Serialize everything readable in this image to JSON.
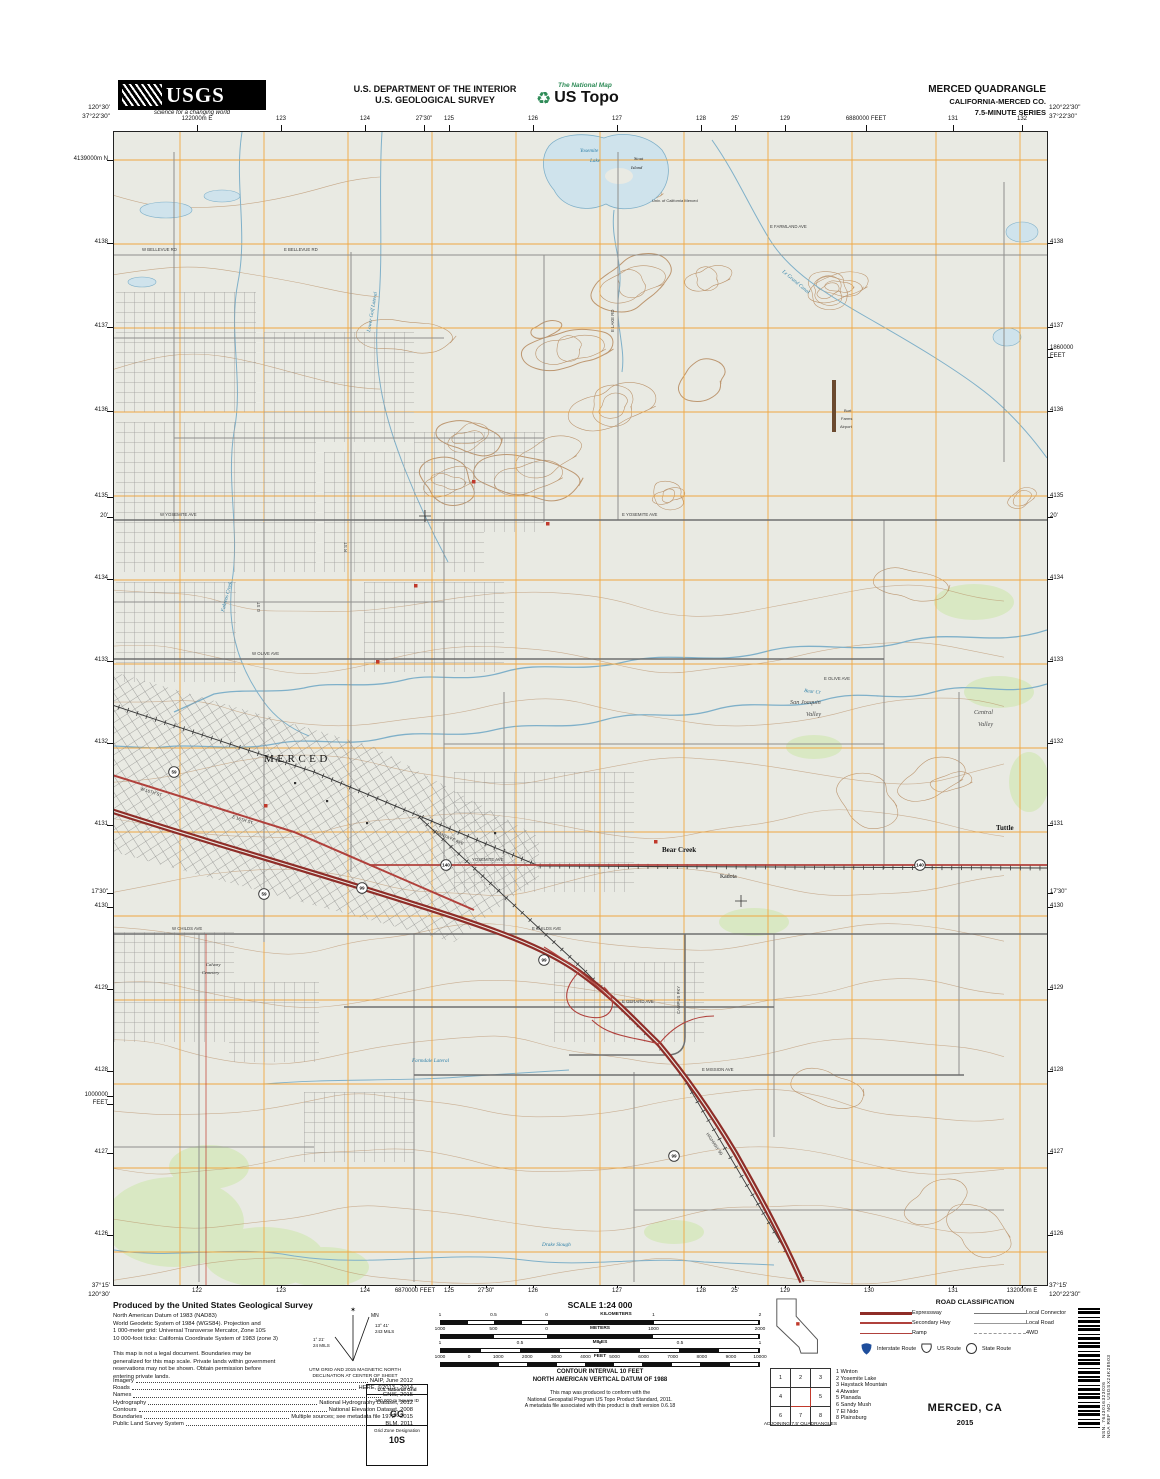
{
  "header": {
    "usgs": "USGS",
    "usgs_tag": "science for a changing world",
    "dept1": "U.S. DEPARTMENT OF THE INTERIOR",
    "dept2": "U.S. GEOLOGICAL SURVEY",
    "natmap": "The National Map",
    "ustopo": "US Topo",
    "quad": "MERCED QUADRANGLE",
    "state": "CALIFORNIA-MERCED CO.",
    "series": "7.5-MINUTE SERIES"
  },
  "collar": {
    "corners": {
      "tl1": "120°30'",
      "tl2": "37°22'30\"",
      "tr1": "120°22'30\"",
      "tr2": "37°22'30\"",
      "bl1": "37°15'",
      "bl2": "120°30'",
      "br1": "37°15'",
      "br2": "120°22'30\""
    },
    "top": [
      [
        "122000m E",
        197
      ],
      [
        "123",
        281
      ],
      [
        "124",
        365
      ],
      [
        "27'30\"",
        424
      ],
      [
        "125",
        449
      ],
      [
        "126",
        533
      ],
      [
        "127",
        617
      ],
      [
        "128",
        701
      ],
      [
        "25'",
        735
      ],
      [
        "129",
        785
      ],
      [
        "6880000 FEET",
        866
      ],
      [
        "131",
        953
      ],
      [
        "132",
        1022
      ]
    ],
    "bottom": [
      [
        "122",
        197
      ],
      [
        "123",
        281
      ],
      [
        "124",
        365
      ],
      [
        "6870000 FEET",
        415
      ],
      [
        "125",
        449
      ],
      [
        "27'30\"",
        486
      ],
      [
        "126",
        533
      ],
      [
        "127",
        617
      ],
      [
        "128",
        701
      ],
      [
        "25'",
        735
      ],
      [
        "129",
        785
      ],
      [
        "130",
        869
      ],
      [
        "131",
        953
      ],
      [
        "132000m E",
        1022
      ]
    ],
    "left": [
      [
        "4139000m N",
        160
      ],
      [
        "4138",
        243
      ],
      [
        "4137",
        327
      ],
      [
        "4136",
        411
      ],
      [
        "4135",
        497
      ],
      [
        "20'",
        517
      ],
      [
        "4134",
        579
      ],
      [
        "4133",
        661
      ],
      [
        "4132",
        743
      ],
      [
        "4131",
        825
      ],
      [
        "17'30\"",
        893
      ],
      [
        "4130",
        907
      ],
      [
        "4129",
        989
      ],
      [
        "4128",
        1071
      ],
      [
        "1000000",
        1096
      ],
      [
        "FEET",
        1104
      ],
      [
        "4127",
        1153
      ],
      [
        "4126",
        1235
      ]
    ],
    "right": [
      [
        "4138",
        243
      ],
      [
        "4137",
        327
      ],
      [
        "1860000",
        349
      ],
      [
        "FEET",
        357
      ],
      [
        "4136",
        411
      ],
      [
        "4135",
        497
      ],
      [
        "20'",
        517
      ],
      [
        "4134",
        579
      ],
      [
        "4133",
        661
      ],
      [
        "4132",
        743
      ],
      [
        "4131",
        825
      ],
      [
        "17'30\"",
        893
      ],
      [
        "4130",
        907
      ],
      [
        "4129",
        989
      ],
      [
        "4128",
        1071
      ],
      [
        "4127",
        1153
      ],
      [
        "4126",
        1235
      ]
    ]
  },
  "map": {
    "labels": [
      {
        "t": "MERCED",
        "x": 150,
        "y": 630,
        "c": "big"
      },
      {
        "t": "Bear Creek",
        "x": 548,
        "y": 720,
        "c": "place-b"
      },
      {
        "t": "Kadota",
        "x": 606,
        "y": 746,
        "c": "place"
      },
      {
        "t": "Tuttle",
        "x": 882,
        "y": 698,
        "c": "place-b"
      },
      {
        "t": "San Joaquin",
        "x": 676,
        "y": 572,
        "c": "valley"
      },
      {
        "t": "Valley",
        "x": 692,
        "y": 584,
        "c": "valley"
      },
      {
        "t": "Central",
        "x": 860,
        "y": 582,
        "c": "valley"
      },
      {
        "t": "Valley",
        "x": 864,
        "y": 594,
        "c": "valley"
      },
      {
        "t": "Yosemite",
        "x": 466,
        "y": 20,
        "c": "water"
      },
      {
        "t": "Lake",
        "x": 476,
        "y": 30,
        "c": "water"
      },
      {
        "t": "Stout",
        "x": 520,
        "y": 28,
        "c": "tinyit"
      },
      {
        "t": "Island",
        "x": 517,
        "y": 37,
        "c": "tinyit"
      },
      {
        "t": "Univ. of California Merced",
        "x": 538,
        "y": 70,
        "c": "tiny"
      },
      {
        "t": "Burt",
        "x": 730,
        "y": 280,
        "c": "tiny"
      },
      {
        "t": "Farms",
        "x": 727,
        "y": 288,
        "c": "tiny"
      },
      {
        "t": "Airport",
        "x": 726,
        "y": 296,
        "c": "tiny"
      },
      {
        "t": "Le Grand Canal",
        "x": 668,
        "y": 140,
        "c": "water",
        "r": 40
      },
      {
        "t": "Lower Golf Lateral",
        "x": 256,
        "y": 200,
        "c": "water",
        "r": -80
      },
      {
        "t": "Fahrens Creek",
        "x": 110,
        "y": 480,
        "c": "water",
        "r": -75
      },
      {
        "t": "Bear Cr",
        "x": 690,
        "y": 560,
        "c": "water",
        "r": 6
      },
      {
        "t": "Drake Slough",
        "x": 428,
        "y": 1114,
        "c": "water"
      },
      {
        "t": "Farmdale Lateral",
        "x": 298,
        "y": 930,
        "c": "water"
      },
      {
        "t": "E BELLEVUE RD",
        "x": 170,
        "y": 119,
        "c": "lr"
      },
      {
        "t": "W BELLEVUE RD",
        "x": 28,
        "y": 119,
        "c": "lr"
      },
      {
        "t": "E FARMLAND AVE",
        "x": 656,
        "y": 96,
        "c": "lr"
      },
      {
        "t": "E YOSEMITE AVE",
        "x": 508,
        "y": 384,
        "c": "lr"
      },
      {
        "t": "W YOSEMITE AVE",
        "x": 46,
        "y": 384,
        "c": "lr"
      },
      {
        "t": "W OLIVE AVE",
        "x": 138,
        "y": 523,
        "c": "lr"
      },
      {
        "t": "E OLIVE AVE",
        "x": 710,
        "y": 548,
        "c": "lr"
      },
      {
        "t": "YOSEMITE AVE",
        "x": 358,
        "y": 729,
        "c": "lr"
      },
      {
        "t": "E CHILDS AVE",
        "x": 418,
        "y": 798,
        "c": "lr"
      },
      {
        "t": "W CHILDS AVE",
        "x": 58,
        "y": 798,
        "c": "lr"
      },
      {
        "t": "E GERARD AVE",
        "x": 508,
        "y": 871,
        "c": "lr"
      },
      {
        "t": "E MISSION AVE",
        "x": 588,
        "y": 939,
        "c": "lr"
      },
      {
        "t": "CAMPUS PKY",
        "x": 566,
        "y": 882,
        "c": "lr",
        "r": -90
      },
      {
        "t": "E SANTA FE AVE",
        "x": 318,
        "y": 700,
        "c": "lr",
        "r": 23
      },
      {
        "t": "E LAKE RD",
        "x": 500,
        "y": 200,
        "c": "lr",
        "r": -90
      },
      {
        "t": "HIGHWAY 99",
        "x": 592,
        "y": 1002,
        "c": "lr",
        "r": 56
      },
      {
        "t": "G ST",
        "x": 146,
        "y": 480,
        "c": "lr",
        "r": -90
      },
      {
        "t": "R ST",
        "x": 233,
        "y": 420,
        "c": "lr",
        "r": -90
      },
      {
        "t": "E 16TH ST",
        "x": 118,
        "y": 686,
        "c": "lr",
        "r": 17
      },
      {
        "t": "W 16TH ST",
        "x": 26,
        "y": 658,
        "c": "lr",
        "r": 17
      },
      {
        "t": "Calvary",
        "x": 92,
        "y": 834,
        "c": "tinyit"
      },
      {
        "t": "Cemetery",
        "x": 88,
        "y": 842,
        "c": "tinyit"
      }
    ],
    "shields": [
      {
        "n": "99",
        "x": 248,
        "y": 756
      },
      {
        "n": "99",
        "x": 430,
        "y": 828
      },
      {
        "n": "99",
        "x": 560,
        "y": 1024
      },
      {
        "n": "140",
        "x": 332,
        "y": 733
      },
      {
        "n": "140",
        "x": 806,
        "y": 733
      },
      {
        "n": "59",
        "x": 60,
        "y": 640
      },
      {
        "n": "59",
        "x": 150,
        "y": 762
      }
    ]
  },
  "footer": {
    "produced_title": "Produced by the United States Geological Survey",
    "datum_lines": [
      "North American Datum of 1983 (NAD83)",
      "World Geodetic System of 1984 (WGS84).  Projection and",
      "1 000-meter grid: Universal Transverse Mercator, Zone 10S",
      "10 000-foot ticks: California Coordinate System of 1983 (zone 3)"
    ],
    "legal_lines": [
      "This map is not a legal document. Boundaries may be",
      "generalized for this map scale. Private lands within government",
      "reservations may not be shown. Obtain permission before",
      "entering private lands."
    ],
    "credits": [
      {
        "k": "Imagery",
        "v": "NAIP, June 2012"
      },
      {
        "k": "Roads",
        "v": "HERE, ©2013 - 2014"
      },
      {
        "k": "Names",
        "v": "GNIS, 2015"
      },
      {
        "k": "Hydrography",
        "v": "National Hydrography Dataset, 2012"
      },
      {
        "k": "Contours",
        "v": "National Elevation Dataset, 2008"
      },
      {
        "k": "Boundaries",
        "v": "Multiple sources; see metadata file 1972 - 2015"
      },
      {
        "k": "Public Land Survey System",
        "v": "BLM, 2011"
      }
    ],
    "decl": {
      "star": "✶",
      "mn": "MN",
      "gn": "GN",
      "mn_deg": "13° 41'",
      "mn_mils": "243 MILS",
      "gn_deg": "1° 21'",
      "gn_mils": "24 MILS",
      "cap1": "UTM GRID AND 2015 MAGNETIC NORTH",
      "cap2": "DECLINATION AT CENTER OF SHEET"
    },
    "usng": {
      "title": "U.S. National Grid",
      "l1": "100,000-m Square ID",
      "sq": "GG",
      "l2": "Grid Zone Designation",
      "zone": "10S"
    },
    "scale": {
      "title": "SCALE 1:24 000",
      "bars": [
        {
          "unit": "KILOMETERS",
          "zero": 0.333,
          "ldiv": 4,
          "rdiv": 2,
          "word_f": 0.55,
          "ticks": [
            [
              "1",
              0
            ],
            [
              "0.5",
              0.167
            ],
            [
              "0",
              0.333
            ],
            [
              "1",
              0.667
            ],
            [
              "2",
              1
            ]
          ]
        },
        {
          "unit": "METERS",
          "zero": 0.333,
          "ldiv": 2,
          "rdiv": 2,
          "word_f": 0.5,
          "ticks": [
            [
              "1000",
              0
            ],
            [
              "500",
              0.167
            ],
            [
              "0",
              0.333
            ],
            [
              "1000",
              0.667
            ],
            [
              "2000",
              1
            ]
          ]
        },
        {
          "unit": "MILES",
          "zero": 0.5,
          "ldiv": 4,
          "rdiv": 4,
          "word_f": 0.5,
          "ticks": [
            [
              "1",
              0
            ],
            [
              "0.5",
              0.25
            ],
            [
              "0",
              0.5
            ],
            [
              "0.5",
              0.75
            ],
            [
              "1",
              1
            ]
          ]
        },
        {
          "unit": "FEET",
          "zero": 0.0909,
          "ldiv": 1,
          "rdiv": 10,
          "word_f": 0.5,
          "ticks": [
            [
              "1000",
              0
            ],
            [
              "0",
              0.0909
            ],
            [
              "1000",
              0.1818
            ],
            [
              "2000",
              0.2727
            ],
            [
              "3000",
              0.3636
            ],
            [
              "4000",
              0.4545
            ],
            [
              "5000",
              0.5455
            ],
            [
              "6000",
              0.6364
            ],
            [
              "7000",
              0.7273
            ],
            [
              "8000",
              0.8182
            ],
            [
              "9000",
              0.9091
            ],
            [
              "10000",
              1
            ]
          ]
        }
      ]
    },
    "contour1": "CONTOUR INTERVAL 10 FEET",
    "contour2": "NORTH AMERICAN VERTICAL DATUM OF 1988",
    "note1": "This map was produced to conform with the",
    "note2": "National Geospatial Program US Topo Product Standard, 2011.",
    "note3": "A metadata file associated with this product is draft version 0.6.18",
    "roadclass": {
      "title": "ROAD CLASSIFICATION",
      "rows": [
        {
          "label": "Expressway",
          "kind": "exp"
        },
        {
          "label": "Local Connector",
          "kind": "lc"
        },
        {
          "label": "Secondary Hwy",
          "kind": "sec"
        },
        {
          "label": "Local Road",
          "kind": "lrd"
        },
        {
          "label": "Ramp",
          "kind": "ramp"
        },
        {
          "label": "4WD",
          "kind": "fwd"
        }
      ],
      "shields": [
        {
          "label": "Interstate Route",
          "kind": "is"
        },
        {
          "label": "US Route",
          "kind": "us"
        },
        {
          "label": "State Route",
          "kind": "st"
        }
      ]
    },
    "adjoining": {
      "caption": "ADJOINING 7.5' QUADRANGLES",
      "cells": [
        "1",
        "2",
        "3",
        "4",
        "",
        "5",
        "6",
        "7",
        "8"
      ],
      "names": [
        "1 Winton",
        "2 Yosemite Lake",
        "3 Haystack Mountain",
        "4 Atwater",
        "5 Planada",
        "6 Sandy Mush",
        "7 El Nido",
        "8 Plainsburg"
      ]
    },
    "title": "MERCED, CA",
    "year": "2015",
    "barcode": {
      "nsn": "NSN. 7643016323026",
      "nga": "NGA REF NO. USGSX24K28503"
    },
    "colors": {
      "expressway": "#8f2d28",
      "secondary": "#b0413c",
      "grid_orange": "#f0a741",
      "water": "#7fb0c9",
      "contour": "#b5885c",
      "veg": "#d9e8c3"
    }
  }
}
